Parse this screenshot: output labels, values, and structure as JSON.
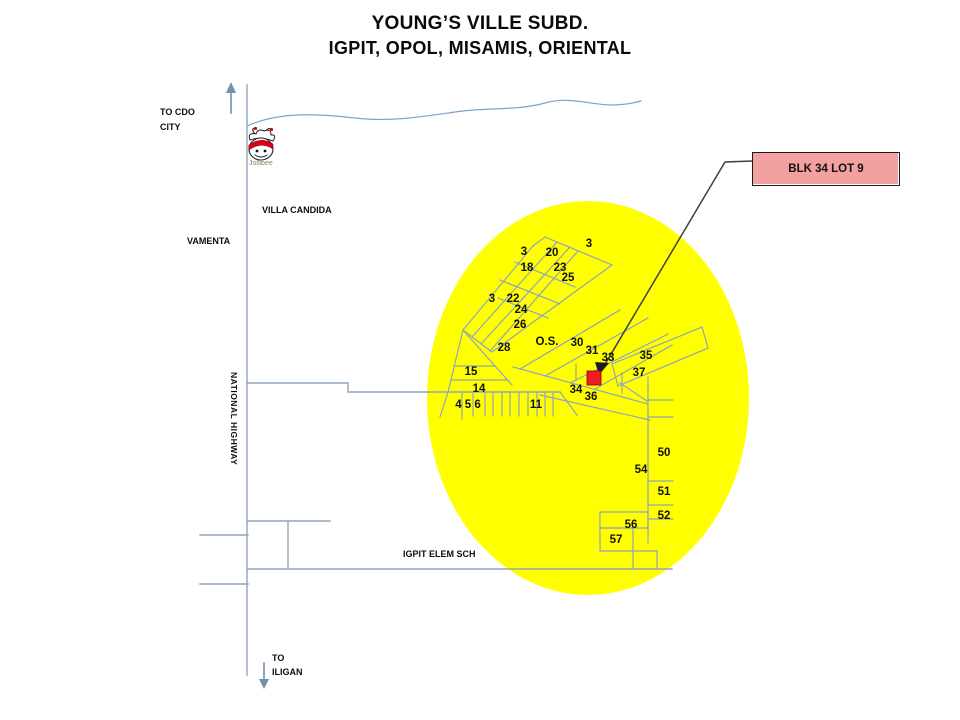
{
  "title": {
    "line1": "YOUNG’S VILLE SUBD.",
    "line2": "IGPIT, OPOL, MISAMIS, ORIENTAL"
  },
  "labels": {
    "to_cdo_line1": "TO CDO",
    "to_cdo_line2": "CITY",
    "villa_candida": "VILLA CANDIDA",
    "vamenta": "VAMENTA",
    "national_highway": "NATIONAL HIGHWAY",
    "igpit_elem_sch": "IGPIT ELEM SCH",
    "to_iligan_line1": "TO",
    "to_iligan_line2": "ILIGAN",
    "jollibee": "Jollibee"
  },
  "callout": {
    "label": "BLK 34 LOT 9"
  },
  "colors": {
    "highlight_ellipse": "#ffff00",
    "callout_fill": "#f2a0a0",
    "marker_red": "#ee1c25",
    "street_line": "#8fa5bd",
    "river_line": "#7aa3cc",
    "arrow": "#7390ad"
  },
  "lots": [
    {
      "label": "3",
      "x": 524,
      "y": 255
    },
    {
      "label": "20",
      "x": 552,
      "y": 256
    },
    {
      "label": "3",
      "x": 589,
      "y": 247
    },
    {
      "label": "18",
      "x": 527,
      "y": 271
    },
    {
      "label": "23",
      "x": 560,
      "y": 271
    },
    {
      "label": "25",
      "x": 568,
      "y": 281
    },
    {
      "label": "3",
      "x": 492,
      "y": 302
    },
    {
      "label": "22",
      "x": 513,
      "y": 302
    },
    {
      "label": "24",
      "x": 521,
      "y": 313
    },
    {
      "label": "26",
      "x": 520,
      "y": 328
    },
    {
      "label": "28",
      "x": 504,
      "y": 351
    },
    {
      "label": "O.S.",
      "x": 547,
      "y": 345
    },
    {
      "label": "30",
      "x": 577,
      "y": 346
    },
    {
      "label": "31",
      "x": 592,
      "y": 354
    },
    {
      "label": "33",
      "x": 608,
      "y": 361
    },
    {
      "label": "35",
      "x": 646,
      "y": 359
    },
    {
      "label": "37",
      "x": 639,
      "y": 376
    },
    {
      "label": "15",
      "x": 471,
      "y": 375
    },
    {
      "label": "14",
      "x": 479,
      "y": 392
    },
    {
      "label": "4 5 6",
      "x": 468,
      "y": 408
    },
    {
      "label": "11",
      "x": 536,
      "y": 408
    },
    {
      "label": "34",
      "x": 576,
      "y": 393
    },
    {
      "label": "36",
      "x": 591,
      "y": 400
    },
    {
      "label": "50",
      "x": 664,
      "y": 456
    },
    {
      "label": "54",
      "x": 641,
      "y": 473
    },
    {
      "label": "51",
      "x": 664,
      "y": 495
    },
    {
      "label": "52",
      "x": 664,
      "y": 519
    },
    {
      "label": "56",
      "x": 631,
      "y": 528
    },
    {
      "label": "57",
      "x": 616,
      "y": 543
    }
  ]
}
